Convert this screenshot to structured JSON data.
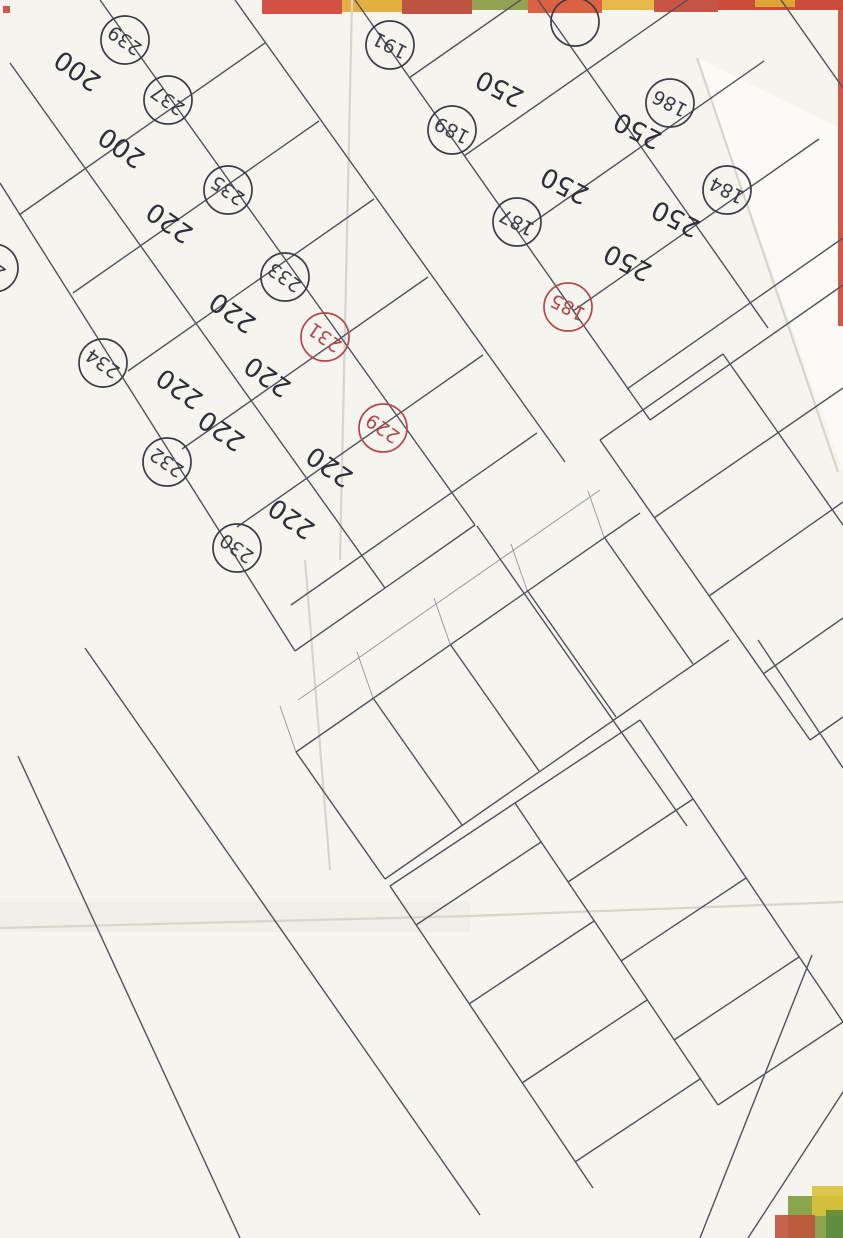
{
  "document": {
    "type": "scanned hand-drawn cadastral subdivision sketch",
    "orientation_note": "survey drawing scanned upside-down; plot labels appear rotated ~210 degrees",
    "paper_color": "#f6f4ef",
    "ink_black": "#3b3b43",
    "ink_red": "#b3474e",
    "stamp_blue": "#2741c4",
    "arrow_red": "#e5380f"
  },
  "map": {
    "plots": [
      {
        "n": "239",
        "c": "black",
        "x": 125,
        "y": 40,
        "rot": 215,
        "area": "200",
        "ax": 78,
        "ay": 70
      },
      {
        "n": "237",
        "c": "black",
        "x": 168,
        "y": 100,
        "rot": 215,
        "area": "200",
        "ax": 122,
        "ay": 147
      },
      {
        "n": "235",
        "c": "black",
        "x": 228,
        "y": 190,
        "rot": 215,
        "area": "220",
        "ax": 170,
        "ay": 222
      },
      {
        "n": "233",
        "c": "black",
        "x": 285,
        "y": 277,
        "rot": 215,
        "area": "220",
        "ax": 233,
        "ay": 312
      },
      {
        "n": "231",
        "c": "red",
        "x": 325,
        "y": 337,
        "rot": 215,
        "area": "220",
        "ax": 268,
        "ay": 376
      },
      {
        "n": "229",
        "c": "red",
        "x": 383,
        "y": 428,
        "rot": 215,
        "area": "220",
        "ax": 330,
        "ay": 466
      },
      {
        "n": "234",
        "c": "black",
        "x": 103,
        "y": 363,
        "rot": 215,
        "area": "220",
        "ax": 180,
        "ay": 388
      },
      {
        "n": "232",
        "c": "black",
        "x": 167,
        "y": 462,
        "rot": 215,
        "area": "220",
        "ax": 222,
        "ay": 430
      },
      {
        "n": "230",
        "c": "black",
        "x": 237,
        "y": 548,
        "rot": 215,
        "area": "220",
        "ax": 292,
        "ay": 518
      },
      {
        "n": "23",
        "c": "black",
        "x": -6,
        "y": 268,
        "rot": 215
      },
      {
        "n": "191",
        "c": "black",
        "x": 390,
        "y": 45,
        "rot": 207
      },
      {
        "n": "189",
        "c": "black",
        "x": 452,
        "y": 130,
        "rot": 207,
        "area": "250",
        "ax": 500,
        "ay": 88
      },
      {
        "n": "187",
        "c": "black",
        "x": 517,
        "y": 222,
        "rot": 207,
        "area": "250",
        "ax": 565,
        "ay": 185
      },
      {
        "n": "185",
        "c": "red",
        "x": 568,
        "y": 307,
        "rot": 207,
        "area": "250",
        "ax": 628,
        "ay": 262
      },
      {
        "n": "186",
        "c": "black",
        "x": 670,
        "y": 103,
        "rot": 207,
        "area": "250",
        "ax": 638,
        "ay": 130
      },
      {
        "n": "184",
        "c": "black",
        "x": 727,
        "y": 190,
        "rot": 207,
        "area": "250",
        "ax": 676,
        "ay": 218
      },
      {
        "n": "",
        "c": "black",
        "x": 575,
        "y": 22,
        "rot": 207
      },
      {
        "n": "183",
        "c": "red",
        "x": 682,
        "y": 470,
        "rot": 207
      },
      {
        "n": "181",
        "c": "black",
        "x": 745,
        "y": 568,
        "rot": 207
      },
      {
        "n": "179",
        "c": "black",
        "x": 828,
        "y": 658,
        "rot": 207
      },
      {
        "n": "228",
        "c": "black",
        "x": 368,
        "y": 793,
        "rot": 212
      },
      {
        "n": "227",
        "c": "black",
        "x": 428,
        "y": 750,
        "rot": 212
      },
      {
        "n": "226",
        "c": "black",
        "x": 502,
        "y": 695,
        "rot": 212
      },
      {
        "n": "225",
        "c": "black",
        "x": 560,
        "y": 658,
        "rot": 212
      },
      {
        "n": "223",
        "c": "black",
        "x": 625,
        "y": 730,
        "rot": 212,
        "area": "200",
        "ax": 600,
        "ay": 770
      },
      {
        "n": "221",
        "c": "black",
        "x": 655,
        "y": 830,
        "rot": 212,
        "area": "200",
        "ax": 598,
        "ay": 868
      },
      {
        "n": "219",
        "c": "black",
        "x": 700,
        "y": 900,
        "rot": 212,
        "area": "200",
        "ax": 645,
        "ay": 928
      },
      {
        "n": "217",
        "c": "black",
        "x": 743,
        "y": 962,
        "rot": 212,
        "area": "200",
        "ax": 690,
        "ay": 1000
      },
      {
        "n": "215",
        "c": "black",
        "x": 830,
        "y": 1050,
        "rot": 212,
        "area": "200",
        "ax": 775,
        "ay": 1088
      },
      {
        "n": "224",
        "c": "black",
        "x": 440,
        "y": 877,
        "rot": 212,
        "area": "200",
        "ax": 490,
        "ay": 830
      },
      {
        "n": "222",
        "c": "red",
        "x": 493,
        "y": 950,
        "rot": 212,
        "area": "200",
        "ax": 547,
        "ay": 903
      },
      {
        "n": "220",
        "c": "red",
        "x": 537,
        "y": 1017,
        "rot": 212,
        "area": "200",
        "ax": 592,
        "ay": 972
      },
      {
        "n": "218",
        "c": "red",
        "x": 577,
        "y": 1080,
        "rot": 212,
        "area": "200",
        "ax": 635,
        "ay": 1030
      },
      {
        "n": "216",
        "c": "red",
        "x": 640,
        "y": 1170,
        "rot": 212,
        "area": "200",
        "ax": 700,
        "ay": 1120
      },
      {
        "n": "",
        "c": "red",
        "x": 672,
        "y": 1232,
        "rot": 212
      }
    ],
    "stray_areas": [
      {
        "t": "200",
        "x": 68,
        "y": 185,
        "rot": 215
      },
      {
        "t": "200",
        "x": 40,
        "y": 205,
        "rot": 215
      },
      {
        "t": "220",
        "x": 115,
        "y": 258,
        "rot": 215
      },
      {
        "t": "220",
        "x": 158,
        "y": 232,
        "rot": 215
      },
      {
        "t": "250",
        "x": 543,
        "y": 45,
        "rot": 207
      },
      {
        "t": "250",
        "x": 603,
        "y": 148,
        "rot": 207
      },
      {
        "t": "250",
        "x": 640,
        "y": 260,
        "rot": 207
      },
      {
        "t": "200",
        "x": 742,
        "y": 1200,
        "rot": 212
      },
      {
        "t": "200",
        "x": 723,
        "y": 1232,
        "rot": 212
      }
    ],
    "dimensions": [
      {
        "t": "11",
        "x": 253,
        "y": 82,
        "rot": 215
      },
      {
        "t": "11",
        "x": 278,
        "y": 162,
        "rot": 215
      },
      {
        "t": "11",
        "x": 385,
        "y": 330,
        "rot": 215
      },
      {
        "t": "11",
        "x": 388,
        "y": 408,
        "rot": 215
      },
      {
        "t": "11",
        "x": 70,
        "y": 427,
        "rot": 215
      },
      {
        "t": "11",
        "x": 128,
        "y": 507,
        "rot": 215
      },
      {
        "t": "11,5",
        "x": 193,
        "y": 587,
        "rot": 215
      },
      {
        "t": "11,5",
        "x": 435,
        "y": 418,
        "rot": 215
      },
      {
        "t": "6",
        "x": 332,
        "y": 606,
        "rot": 215
      },
      {
        "t": "9",
        "x": 580,
        "y": 540,
        "rot": 212
      },
      {
        "t": "11,5",
        "x": 725,
        "y": 75,
        "rot": 207
      },
      {
        "t": "9",
        "x": 480,
        "y": 383,
        "rot": 207
      },
      {
        "t": "6",
        "x": 662,
        "y": 370,
        "rot": 207
      },
      {
        "t": "11",
        "x": 640,
        "y": 495,
        "rot": 207
      },
      {
        "t": "11",
        "x": 690,
        "y": 585,
        "rot": 207
      },
      {
        "t": "11",
        "x": 745,
        "y": 663,
        "rot": 207
      },
      {
        "t": "9",
        "x": 645,
        "y": 770,
        "rot": 207
      },
      {
        "t": "10",
        "x": 355,
        "y": 660,
        "rot": 212
      },
      {
        "t": "10",
        "x": 425,
        "y": 610,
        "rot": 212
      },
      {
        "t": "10",
        "x": 492,
        "y": 565,
        "rot": 212
      },
      {
        "t": "20,65",
        "x": 312,
        "y": 783,
        "rot": 212
      },
      {
        "t": "20,65",
        "x": 552,
        "y": 607,
        "rot": 212
      },
      {
        "t": "10",
        "x": 687,
        "y": 790,
        "rot": 212
      },
      {
        "t": "10",
        "x": 740,
        "y": 872,
        "rot": 212
      },
      {
        "t": "10",
        "x": 790,
        "y": 943,
        "rot": 212
      },
      {
        "t": "10",
        "x": 443,
        "y": 967,
        "rot": 212
      },
      {
        "t": "10",
        "x": 493,
        "y": 1037,
        "rot": 212
      },
      {
        "t": "10",
        "x": 543,
        "y": 1117,
        "rot": 212
      },
      {
        "t": "10",
        "x": 597,
        "y": 1180,
        "rot": 212
      },
      {
        "t": "20",
        "x": 623,
        "y": 1128,
        "rot": 212
      },
      {
        "t": "10",
        "x": 795,
        "y": 1162,
        "rot": 212
      }
    ],
    "annotations_black": [
      {
        "t": "قتيبة",
        "x": 193,
        "y": 272,
        "rot": 215
      },
      {
        "t": "حمد",
        "x": 332,
        "y": 405,
        "rot": 215
      },
      {
        "t": "حمد",
        "x": 415,
        "y": 468,
        "rot": 215
      },
      {
        "t": "قتيبة",
        "x": 660,
        "y": 277,
        "rot": 207
      },
      {
        "t": "قتيبة",
        "x": 750,
        "y": 448,
        "rot": 207
      },
      {
        "t": "كامل",
        "x": 540,
        "y": 765,
        "rot": 212
      }
    ],
    "annotations_red": [
      {
        "t": "عماد",
        "x": 512,
        "y": 880,
        "rot": 212
      },
      {
        "t": "عماد",
        "x": 572,
        "y": 1008,
        "rot": 212
      },
      {
        "t": "عماد",
        "x": 530,
        "y": 1075,
        "rot": 212
      },
      {
        "t": "عماد",
        "x": 645,
        "y": 1085,
        "rot": 212
      },
      {
        "t": "عماد",
        "x": 680,
        "y": 1155,
        "rot": 212
      }
    ],
    "pencil_notes": [
      {
        "t": "مـ 69",
        "x": 40,
        "y": 552,
        "rot": 205,
        "size": 19,
        "color": "#3b4563"
      },
      {
        "t": "187.24",
        "x": 128,
        "y": 762,
        "rot": 242,
        "size": 21,
        "color": "#4a4a52"
      }
    ],
    "stamp": {
      "t": "مكتب الخليفة الهندسي",
      "x": 213,
      "y": 1020,
      "rot": 96,
      "size": 25,
      "color": "#2741c4"
    },
    "lines": [
      [
        235,
        0,
        565,
        462
      ],
      [
        100,
        0,
        475,
        525
      ],
      [
        10,
        63,
        385,
        588
      ],
      [
        0,
        183,
        295,
        651
      ],
      [
        265,
        43,
        19,
        215
      ],
      [
        319,
        121,
        73,
        293
      ],
      [
        374,
        199,
        128,
        371
      ],
      [
        428,
        277,
        182,
        449
      ],
      [
        483,
        355,
        237,
        527
      ],
      [
        537,
        433,
        291,
        605
      ],
      [
        475,
        525,
        295,
        651
      ],
      [
        355,
        0,
        650,
        420
      ],
      [
        538,
        0,
        768,
        328
      ],
      [
        781,
        0,
        843,
        88
      ],
      [
        409,
        78,
        645,
        -87
      ],
      [
        464,
        156,
        710,
        -16
      ],
      [
        518,
        233,
        764,
        61
      ],
      [
        573,
        311,
        819,
        139
      ],
      [
        627,
        389,
        843,
        238
      ],
      [
        650,
        420,
        843,
        285
      ],
      [
        600,
        440,
        810,
        740
      ],
      [
        723,
        354,
        843,
        525
      ],
      [
        600,
        440,
        723,
        354
      ],
      [
        654,
        518,
        843,
        388
      ],
      [
        709,
        596,
        843,
        502
      ],
      [
        763,
        674,
        843,
        618
      ],
      [
        810,
        740,
        843,
        717
      ],
      [
        477,
        526,
        687,
        826
      ],
      [
        296,
        752,
        640,
        513
      ],
      [
        385,
        879,
        729,
        640
      ],
      [
        296,
        752,
        385,
        879
      ],
      [
        373,
        698,
        462,
        825
      ],
      [
        450,
        644,
        539,
        771
      ],
      [
        527,
        590,
        616,
        717
      ],
      [
        604,
        537,
        693,
        664
      ],
      [
        640,
        720,
        843,
        1022
      ],
      [
        515,
        803,
        718,
        1105
      ],
      [
        390,
        886,
        593,
        1188
      ],
      [
        640,
        720,
        390,
        886
      ],
      [
        693,
        799,
        568,
        882
      ],
      [
        746,
        878,
        621,
        961
      ],
      [
        799,
        957,
        674,
        1040
      ],
      [
        843,
        1022,
        718,
        1105
      ],
      [
        541,
        842,
        416,
        925
      ],
      [
        594,
        921,
        469,
        1004
      ],
      [
        647,
        1000,
        522,
        1083
      ],
      [
        700,
        1079,
        575,
        1162
      ],
      [
        758,
        640,
        843,
        768
      ],
      [
        812,
        955,
        700,
        1238
      ],
      [
        843,
        1092,
        748,
        1238
      ],
      [
        85,
        648,
        480,
        1215
      ],
      [
        18,
        756,
        240,
        1238
      ]
    ],
    "light_lines": [
      [
        298,
        700,
        600,
        490
      ],
      [
        296,
        752,
        280,
        706
      ],
      [
        373,
        698,
        357,
        652
      ],
      [
        450,
        644,
        434,
        598
      ],
      [
        527,
        590,
        511,
        544
      ],
      [
        604,
        537,
        588,
        491
      ]
    ],
    "creases": [
      [
        352,
        0,
        340,
        560
      ],
      [
        305,
        560,
        330,
        870
      ],
      [
        0,
        928,
        470,
        916
      ],
      [
        470,
        916,
        843,
        902
      ],
      [
        697,
        58,
        838,
        472
      ]
    ],
    "big_arrows": [
      {
        "points": "0,912 348,848 338,806 470,860 330,948 342,902 0,934"
      },
      {
        "points": "234,1238 380,966 352,950 452,902 468,1012 436,998 290,1238"
      }
    ],
    "scan_strips": [
      {
        "x": 262,
        "y": 0,
        "w": 80,
        "h": 14,
        "f": "#cf4030"
      },
      {
        "x": 342,
        "y": 0,
        "w": 60,
        "h": 12,
        "f": "#e0a82c"
      },
      {
        "x": 402,
        "y": 0,
        "w": 70,
        "h": 14,
        "f": "#b9422f"
      },
      {
        "x": 472,
        "y": 0,
        "w": 56,
        "h": 10,
        "f": "#8a9a40"
      },
      {
        "x": 528,
        "y": 0,
        "w": 74,
        "h": 13,
        "f": "#d9512f"
      },
      {
        "x": 602,
        "y": 0,
        "w": 52,
        "h": 10,
        "f": "#e3b33a"
      },
      {
        "x": 654,
        "y": 0,
        "w": 64,
        "h": 12,
        "f": "#c24434"
      },
      {
        "x": 718,
        "y": 0,
        "w": 125,
        "h": 10,
        "f": "#c83a28"
      },
      {
        "x": 755,
        "y": 0,
        "w": 40,
        "h": 7,
        "f": "#e0ae33"
      },
      {
        "x": 838,
        "y": 6,
        "w": 5,
        "h": 320,
        "f": "#c74936"
      },
      {
        "x": 3,
        "y": 6,
        "w": 7,
        "h": 7,
        "f": "#c64a35"
      },
      {
        "x": 788,
        "y": 1196,
        "w": 55,
        "h": 42,
        "f": "#7f9c3d"
      },
      {
        "x": 812,
        "y": 1186,
        "w": 31,
        "h": 30,
        "f": "#d9c23a"
      },
      {
        "x": 775,
        "y": 1215,
        "w": 40,
        "h": 23,
        "f": "#c0533b"
      },
      {
        "x": 826,
        "y": 1210,
        "w": 17,
        "h": 28,
        "f": "#5d8a3c"
      }
    ],
    "ink_paths": [
      {
        "d": "M142,655 q14,-12 20,0 q-16,22 2,22 q16,-2 12,-18 q12,-8 18,4 q-14,22 4,24 q16,0 12,-16 q12,-10 18,2 q-12,22 6,24 q16,0 14,-14 q10,-8 16,4 l8,10",
        "rot": "rotate(36 142 655)",
        "stroke": "#2a35a0",
        "w": 1.6
      },
      {
        "d": "M122,690 q12,-10 18,0 q-12,20 2,20 q14,-2 11,-16 q11,-8 16,2 q-12,20 4,22 q14,0 11,-14 q10,-8 15,2 l10,12",
        "rot": "rotate(36 122 690)",
        "stroke": "#2a35a0",
        "w": 1.6
      },
      {
        "d": "M107,578 L120,541 l-8,3 m8,-3 l1,9",
        "stroke": "#c3322a",
        "w": 2
      },
      {
        "d": "M228,1098 L231,1037 l-6,8 m6,-8 l6,8",
        "stroke": "#c3322a",
        "w": 2
      },
      {
        "d": "M150,467 L92,510 l12,1 m-12,-1 l6,-10",
        "stroke": "#70707a",
        "w": 1.5
      },
      {
        "d": "M368,1232 q10,-14 20,-6 q10,8 18,2 q-8,8 -16,6",
        "stroke": "#1b1b1b",
        "w": 2.5
      },
      {
        "d": "M492,1224 l14,8",
        "stroke": "#1b1b1b",
        "w": 2
      }
    ],
    "blue_blob": {
      "x": 88,
      "y": 484,
      "r": 4,
      "f": "#2a35a0"
    }
  }
}
